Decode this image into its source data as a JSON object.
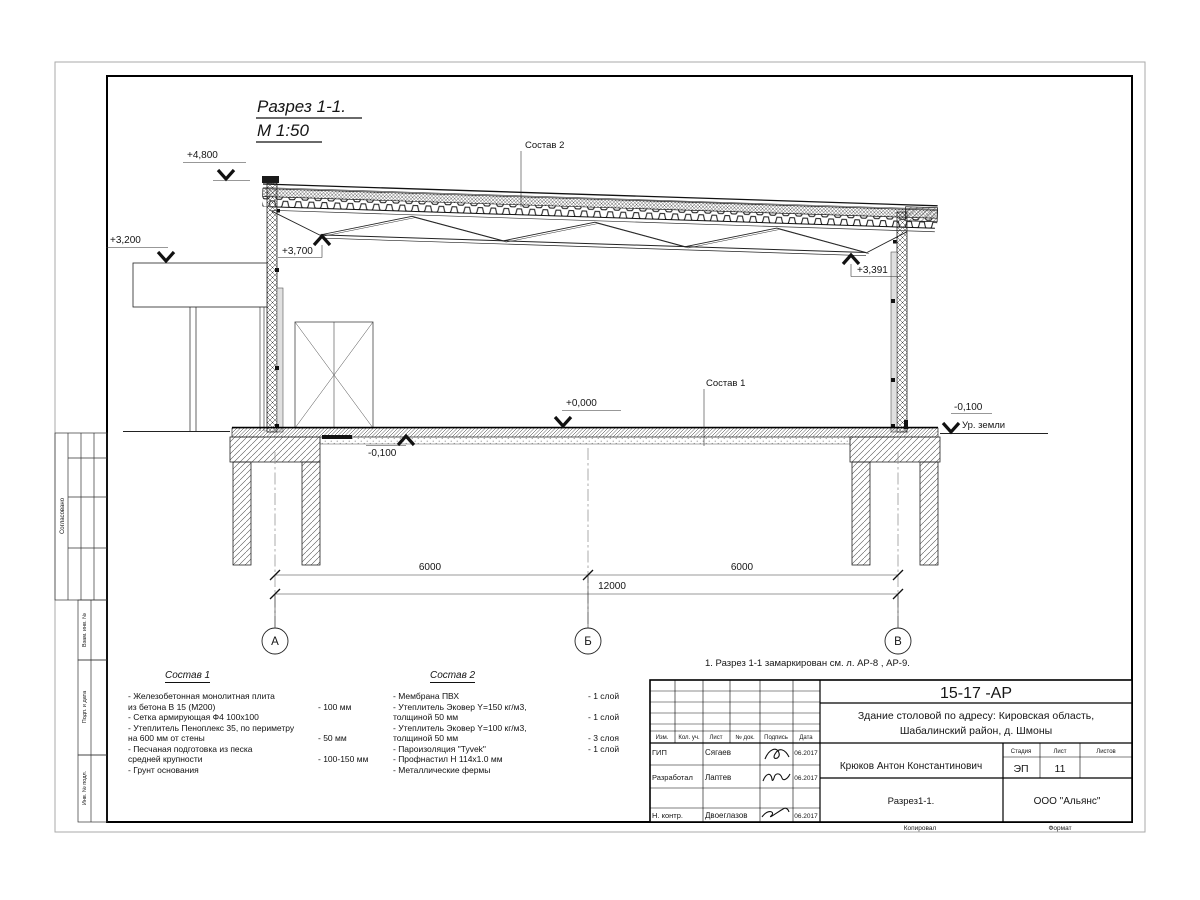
{
  "sheet": {
    "view_title": "Разрез 1-1.",
    "view_scale": "М 1:50",
    "note": "1. Разрез 1-1 замаркирован см. л. АР-8 , АР-9."
  },
  "elevations": {
    "roof_top": "+4,800",
    "canopy": "+3,200",
    "truss_left": "+3,700",
    "truss_right": "+3,391",
    "floor": "+0,000",
    "slab_edge": "-0,100",
    "ground": "-0,100",
    "ground_label": "Ур. земли"
  },
  "callouts": {
    "comp1": "Состав 1",
    "comp2": "Состав 2"
  },
  "grid": {
    "axis_a": "А",
    "axis_b": "Б",
    "axis_v": "В",
    "dim_left": "6000",
    "dim_right": "6000",
    "dim_total": "12000"
  },
  "composition1": {
    "title": "Состав 1",
    "items": [
      {
        "name": "- Железобетонная  монолитная плита\nиз бетона В 15 (М200)",
        "value": "- 100 мм"
      },
      {
        "name": "- Сетка армирующая Ф4 100х100",
        "value": ""
      },
      {
        "name": "- Утеплитель Пеноплекс 35, по периметру\nна 600 мм от стены",
        "value": "- 50 мм"
      },
      {
        "name": "- Песчаная подготовка из песка\nсредней крупности",
        "value": "- 100-150 мм"
      },
      {
        "name": "- Грунт основания",
        "value": ""
      }
    ]
  },
  "composition2": {
    "title": "Состав 2",
    "items": [
      {
        "name": "- Мембрана ПВХ",
        "value": "- 1 слой"
      },
      {
        "name": "- Утеплитель Эковер Y=150 кг/м3,\nтолщиной 50 мм",
        "value": "- 1 слой"
      },
      {
        "name": "- Утеплитель Эковер Y=100 кг/м3,\nтолщиной 50 мм",
        "value": "- 3 слоя"
      },
      {
        "name": "- Пароизоляция \"Tyvek\"",
        "value": "- 1 слой"
      },
      {
        "name": "- Профнастил Н 114х1.0 мм",
        "value": ""
      },
      {
        "name": "- Металлические фермы",
        "value": ""
      }
    ]
  },
  "stamp": {
    "doc_number": "15-17 -АР",
    "object_line1": "Здание столовой по адресу: Кировская область,",
    "object_line2": "Шабалинский район, д. Шмоны",
    "customer": "Крюков Антон Константинович",
    "cols": {
      "izm": "Изм.",
      "kol": "Кол. уч.",
      "list": "Лист",
      "ndok": "№ док.",
      "podpis": "Подпись",
      "data": "Дата"
    },
    "rows": [
      {
        "role": "ГИП",
        "name": "Сягаев",
        "date": "06.2017"
      },
      {
        "role": "Разработал",
        "name": "Лаптев",
        "date": "06.2017"
      },
      {
        "role": "Н. контр.",
        "name": "Двоеглазов",
        "date": "06.2017"
      }
    ],
    "stage_label": "Стадия",
    "sheet_label": "Лист",
    "sheets_label": "Листов",
    "stage": "ЭП",
    "sheet_no": "11",
    "drawing_title": "Разрез1-1.",
    "company": "ООО \"Альянс\"",
    "copied_label": "Копировал",
    "format_label": "Формат"
  },
  "side_labels": {
    "approved": "Согласовано",
    "vzam": "Взам. инв. №",
    "podp": "Подп. и дата",
    "inv": "Инв. № подл."
  }
}
